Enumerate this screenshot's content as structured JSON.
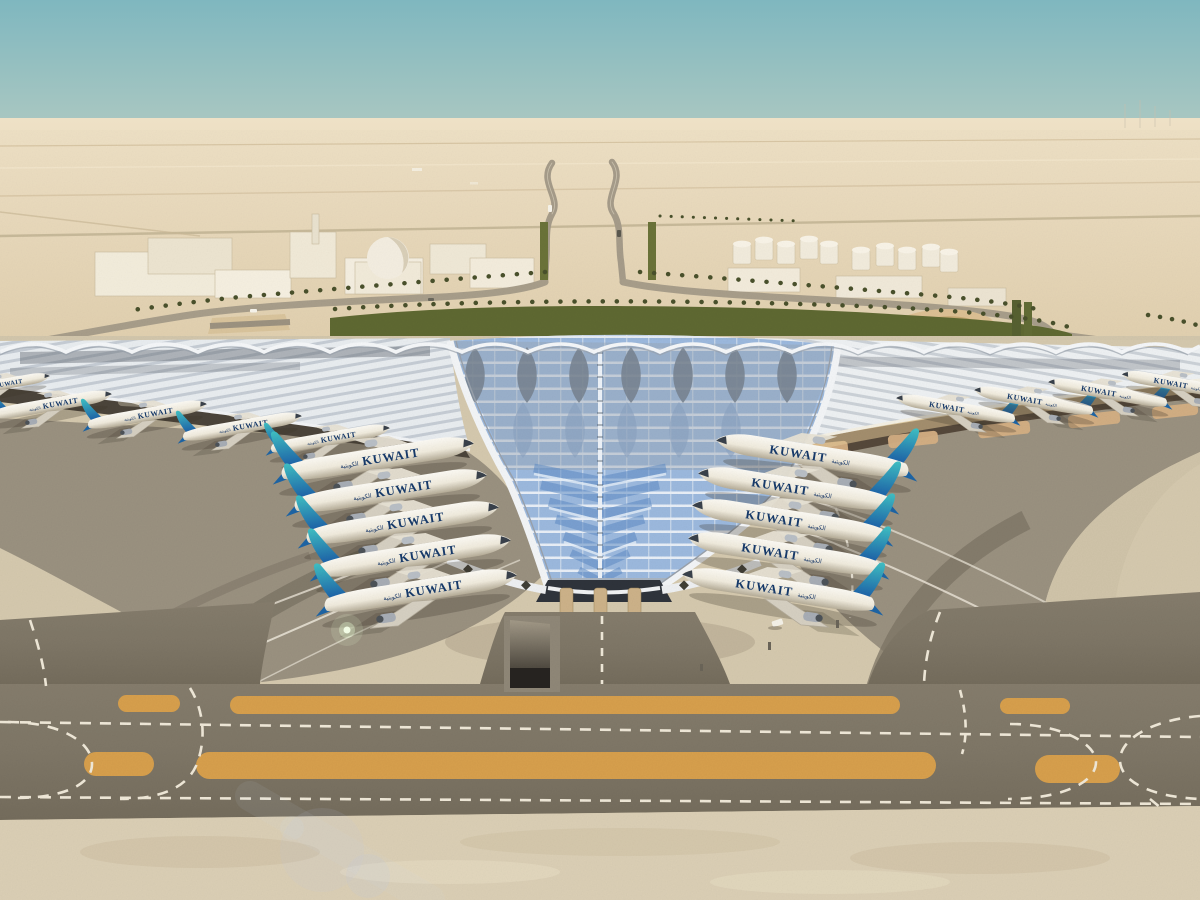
{
  "scene": {
    "description": "Aerial architectural rendering of Kuwait International Airport new passenger terminal with trefoil solar roof, Kuwait Airways aircraft at gates, desert landside with palm-lined approach roads, and airside taxiways in the foreground",
    "aircraft": {
      "livery_text": "KUWAIT",
      "livery_text_arabic": "الكويتية",
      "gates_left_count": 5,
      "gates_right_count": 5,
      "distant_left_count": 4,
      "distant_right_count": 4
    },
    "palette": {
      "sky_top": "#7fb7bf",
      "sky_haze": "#e9dcc2",
      "desert_sand": "#e8d8ba",
      "roof_silver": "#e6eaee",
      "roof_rib_shadow": "#c7cdd5",
      "roof_glass_blue": "#9cb9de",
      "roof_glass_rib": "#e9eff7",
      "tail_teal": "#3fc0c4",
      "tail_blue": "#1b5ca6",
      "livery_navy": "#173a6a",
      "greenery": "#5e6831",
      "palm_green": "#49502b",
      "apron_gray": "#9a9180",
      "apron_light": "#d5c9ae",
      "taxiway_asphalt": "#7e7666",
      "marking_orange": "#d79f4c",
      "marking_white": "#efe8d8",
      "column_tan": "#cdb289"
    }
  }
}
